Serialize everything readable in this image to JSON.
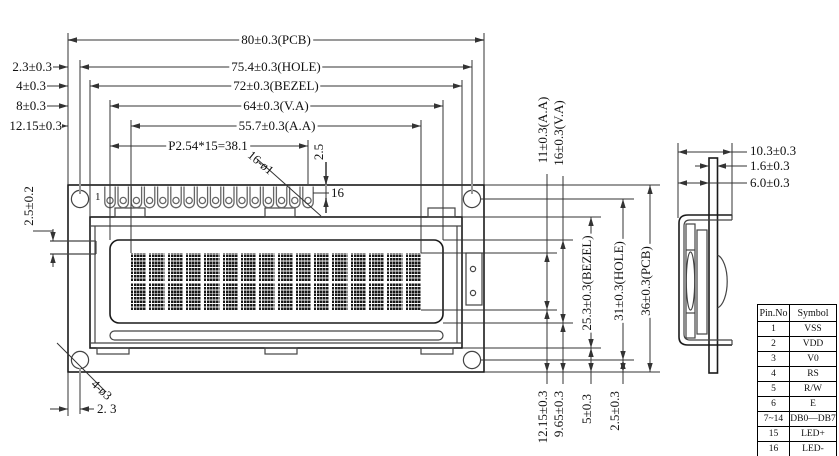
{
  "dims": {
    "top": [
      "80±0.3(PCB)",
      "75.4±0.3(HOLE)",
      "72±0.3(BEZEL)",
      "64±0.3(V.A)",
      "55.7±0.3(A.A)",
      "P2.54*15=38.1"
    ],
    "left": [
      "2.3±0.3",
      "4±0.3",
      "8±0.3",
      "12.15±0.3"
    ],
    "left_step": "2.5±0.2",
    "right": [
      "11±0.3(A.A)",
      "16±0.3(V.A)",
      "25.3±0.3(BEZEL)",
      "31±0.3(HOLE)",
      "36±0.3(PCB)"
    ],
    "bottom": [
      "12.15±0.3",
      "9.65±0.3",
      "5±0.3",
      "2.5±0.3"
    ],
    "side": [
      "10.3±0.3",
      "1.6±0.3",
      "6.0±0.3"
    ],
    "pin_first": "1",
    "pin_last": "16",
    "pin_holes": "16-ø1",
    "pin_edge": "2.5",
    "corner_holes": "4-ø3",
    "corner_offset": "2. 3"
  },
  "lcd": {
    "columns": 16,
    "rows": 2
  },
  "pins": {
    "count": 16
  },
  "pin_table": {
    "headers": [
      "Pin.No",
      "Symbol"
    ],
    "rows": [
      [
        "1",
        "VSS"
      ],
      [
        "2",
        "VDD"
      ],
      [
        "3",
        "V0"
      ],
      [
        "4",
        "RS"
      ],
      [
        "5",
        "R/W"
      ],
      [
        "6",
        "E"
      ],
      [
        "7~14",
        "DB0—DB7"
      ],
      [
        "15",
        "LED+"
      ],
      [
        "16",
        "LED-"
      ]
    ]
  }
}
